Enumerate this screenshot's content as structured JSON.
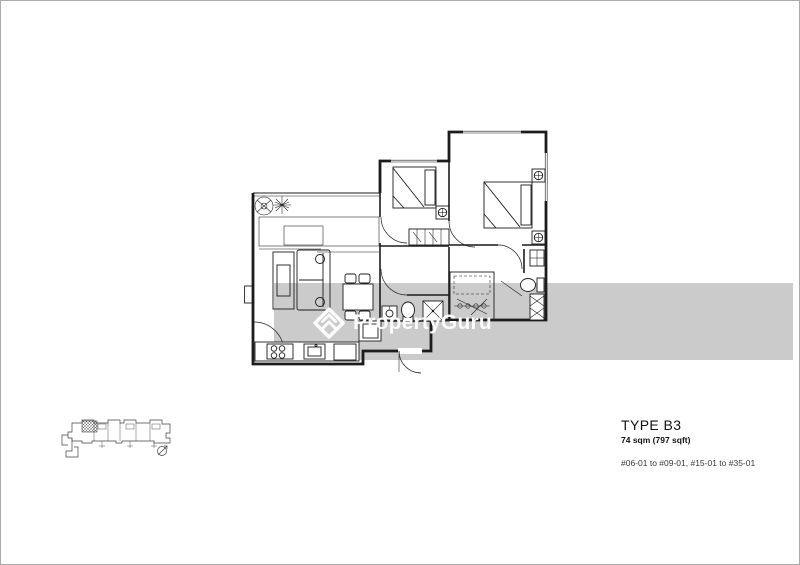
{
  "page": {
    "width": 800,
    "height": 565
  },
  "colors": {
    "paper": "#ffffff",
    "page_border": "#ababab",
    "plan_line": "#1c1c1c",
    "band": "#cbcbcb",
    "watermark_text": "#ffffff",
    "text_primary": "#121212",
    "text_secondary": "#3a3a3a",
    "keyplan_line": "#444444"
  },
  "watermark": {
    "brand": "PropertyGuru",
    "logo_icon": "propertyguru-diamond-chevron-logo"
  },
  "unit_info": {
    "type_label": "TYPE B3",
    "area_label": "74 sqm (797 sqft)",
    "stack_label": "#06-01 to #09-01, #15-01 to #35-01"
  }
}
